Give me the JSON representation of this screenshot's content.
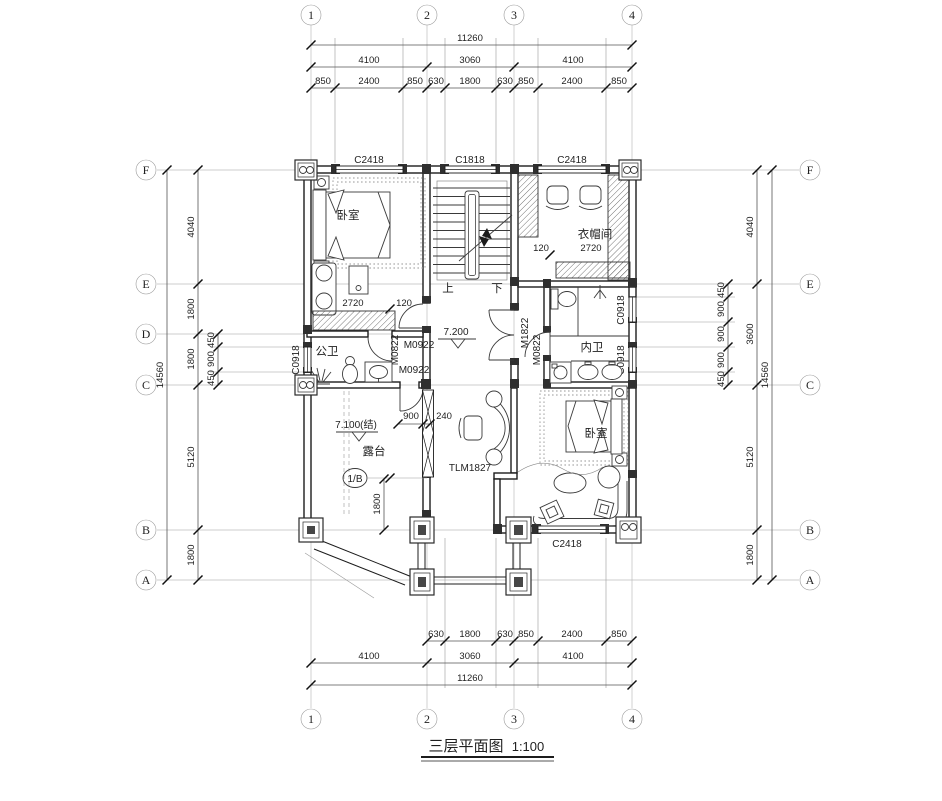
{
  "title": {
    "name": "三层平面图",
    "scale": "1:100"
  },
  "grid_bubbles": {
    "cols": [
      "1",
      "2",
      "3",
      "4"
    ],
    "left": [
      "F",
      "E",
      "D",
      "C",
      "B",
      "A"
    ],
    "right": [
      "F",
      "E",
      "C",
      "B",
      "A"
    ]
  },
  "dims": {
    "top": {
      "total": "11260",
      "majors": [
        "4100",
        "3060",
        "4100"
      ],
      "minors": [
        "850",
        "2400",
        "850",
        "630",
        "1800",
        "630",
        "850",
        "2400",
        "850"
      ]
    },
    "bottom": {
      "total": "11260",
      "majors": [
        "4100",
        "3060",
        "4100"
      ],
      "minors": [
        "630",
        "1800",
        "630",
        "850",
        "2400",
        "850"
      ]
    },
    "left": {
      "total": "14560",
      "majors": [
        "4040",
        "1800",
        "1800",
        "5120",
        "1800"
      ],
      "minors": [
        "450",
        "900",
        "450"
      ]
    },
    "right": {
      "total": "14560",
      "majors": [
        "4040",
        "3600",
        "5120",
        "1800"
      ],
      "minors": [
        "450",
        "900",
        "900",
        "900",
        "450"
      ]
    }
  },
  "windows": {
    "top_left": "C2418",
    "top_mid": "C1818",
    "top_right": "C2418",
    "bottom": "C2418",
    "left": "C0918",
    "right_upper": "C0918",
    "right_lower": "C0918"
  },
  "doors": {
    "nw_upper": "M0922",
    "nw_lower": "M0922",
    "pub_bath": "M0822",
    "hall_double": "M1822",
    "priv_bath": "M0822",
    "terrace_sliding": "TLM1827"
  },
  "rooms": {
    "bedroom_nw": "卧室",
    "cloakroom": "衣帽间",
    "bath_public": "公卫",
    "bath_private": "内卫",
    "bedroom_se": "卧室",
    "terrace": "露台"
  },
  "levels": {
    "hall": "7.200",
    "terrace": "7.100(结)"
  },
  "stairs": {
    "up": "上",
    "down": "下"
  },
  "inline_dims": {
    "nw_a": "2720",
    "nw_b": "120",
    "ne_a": "120",
    "ne_b": "2720",
    "terrace_a": "900",
    "terrace_b": "240",
    "terrace_c": "1800"
  },
  "markers": {
    "detail": "1/B"
  }
}
